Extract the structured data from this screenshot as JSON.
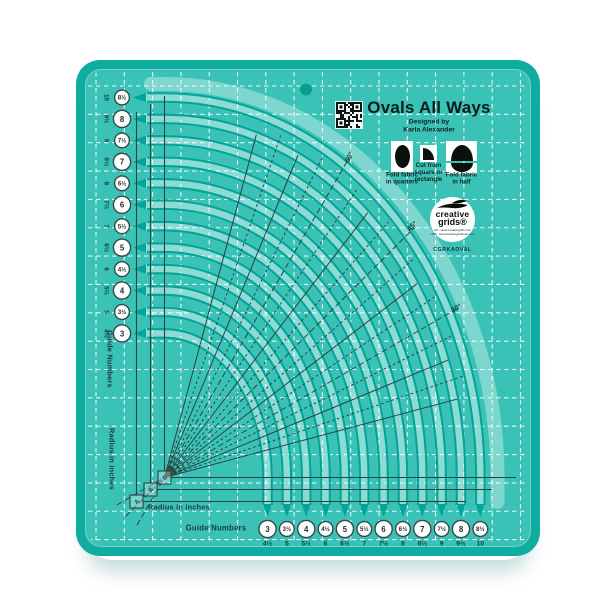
{
  "header": {
    "title": "Ovals All Ways",
    "designed_by": "Designed by",
    "designer": "Karla Alexander"
  },
  "instructions": [
    {
      "icon": "full-oval-icon",
      "lines": [
        "Fold fabric",
        "in quarters"
      ]
    },
    {
      "icon": "quarter-oval-icon",
      "lines": [
        "Cut from",
        "square or",
        "rectangle"
      ]
    },
    {
      "icon": "half-oval-icon",
      "lines": [
        "Fold fabric",
        "in half"
      ]
    }
  ],
  "logo": {
    "brand_line1": "creative",
    "brand_line2": "grids®",
    "url_uk": "UK : www.creativegrids.com",
    "url_usa": "USA : www.creativegridsusa.com",
    "product_code": "CGRKAOVAL"
  },
  "angles": [
    "60°",
    "45°",
    "30°"
  ],
  "channels": [
    "C",
    "B",
    "A"
  ],
  "scales": {
    "left": {
      "title": "Guide Numbers",
      "radius_title": "Radius in inches",
      "entries": [
        {
          "guide": "8½",
          "radius": "10"
        },
        {
          "guide": "8",
          "radius": "9½"
        },
        {
          "guide": "7½",
          "radius": "9"
        },
        {
          "guide": "7",
          "radius": "8½"
        },
        {
          "guide": "6½",
          "radius": "8"
        },
        {
          "guide": "6",
          "radius": "7½"
        },
        {
          "guide": "5½",
          "radius": "7"
        },
        {
          "guide": "5",
          "radius": "6½"
        },
        {
          "guide": "4½",
          "radius": "6"
        },
        {
          "guide": "4",
          "radius": "5½"
        },
        {
          "guide": "3½",
          "radius": "5"
        },
        {
          "guide": "3",
          "radius": "4½"
        }
      ]
    },
    "bottom": {
      "title": "Guide Numbers",
      "radius_title": "Radius in inches",
      "entries": [
        {
          "guide": "3",
          "radius": "4½"
        },
        {
          "guide": "3½",
          "radius": "5"
        },
        {
          "guide": "4",
          "radius": "5½"
        },
        {
          "guide": "4½",
          "radius": "6"
        },
        {
          "guide": "5",
          "radius": "6½"
        },
        {
          "guide": "5½",
          "radius": "7"
        },
        {
          "guide": "6",
          "radius": "7½"
        },
        {
          "guide": "6½",
          "radius": "8"
        },
        {
          "guide": "7",
          "radius": "8½"
        },
        {
          "guide": "7½",
          "radius": "9"
        },
        {
          "guide": "8",
          "radius": "9½"
        },
        {
          "guide": "8½",
          "radius": "10"
        }
      ]
    }
  },
  "colors": {
    "frame": "#0faca0",
    "body": "#3ac2b7",
    "band": "#ffffff",
    "arc_line": "#03a598",
    "ink": "#2a4341",
    "badge_fill": "#fdfffe",
    "badge_ring": "#364947",
    "badge_text": "#22302f"
  }
}
